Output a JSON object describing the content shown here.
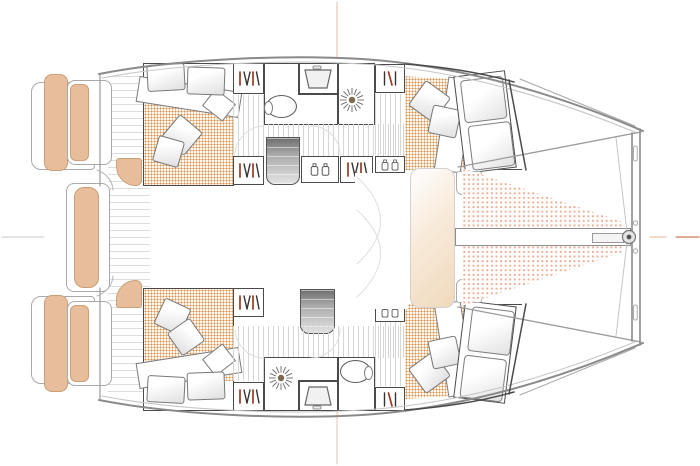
{
  "document": {
    "kind": "Catamaran interior deck plan, top-down line drawing, bow to the right",
    "visible_text": "none",
    "view": "hull accommodation level with aft cockpit and foredeck trampoline"
  },
  "theme": {
    "colors": {
      "outline_dark": "#4a4a4a",
      "outline_mid": "#8e8e8e",
      "outline_soft": "#c6c6c6",
      "cushion": "#e7bd9b",
      "cushion_edge": "#c9a078",
      "mattress_dot": "#dc9150",
      "mattress_bg": "#fdf7ee",
      "tramp_dot": "#eaab92",
      "tramp_bg": "#fffdfc",
      "plank": "#d6d6d6",
      "steps_dark": "#6e6e6e",
      "steps_light": "#e4e4e4",
      "hanger_red": "#9c3a22",
      "hanger_ink": "#333333",
      "centerline": "#c75f3d",
      "panel_beige": "#f0d9bd"
    }
  },
  "regions": {
    "stern_cockpit": {
      "swim_platforms": 2,
      "bench_cushions_tan": 5,
      "hull_entry_pads": 2,
      "floor": "planked"
    },
    "port_hull_top": {
      "aft_cabin": {
        "double_berth": true,
        "pillows": 2,
        "scatter_cushions": 2,
        "mattress_texture": "orange dots"
      },
      "head": {
        "toilet": 1,
        "sink": 1,
        "shower_with_drain_rose": 1
      },
      "wardrobes_with_hangers": 3,
      "lockers_with_jars": 2,
      "companionway_steps": 1,
      "forward_cabin": {
        "double_berth": true,
        "pillows": 2,
        "scatter_cushions": 2
      }
    },
    "starboard_hull_bottom": {
      "aft_cabin": {
        "double_berth": true,
        "pillows": 2,
        "scatter_cushions": 2,
        "mattress_texture": "orange dots"
      },
      "head": {
        "toilet": 1,
        "sink": 1,
        "shower_with_drain_rose": 1
      },
      "wardrobes_with_hangers": 3,
      "lockers_with_jars": 2,
      "companionway_steps": 1,
      "forward_cabin": {
        "double_berth": true,
        "pillows": 2,
        "scatter_cushions": 2
      }
    },
    "foredeck": {
      "trampoline_panels": 2,
      "bowsprit_beam": true,
      "bow_crossbeam": true,
      "bridle_lines": 2,
      "forward_lounge_panel": "beige gradient"
    },
    "drawing_marks": {
      "centerline_ticks": [
        "top orange",
        "bottom orange",
        "left grey",
        "right orange-red"
      ]
    }
  },
  "icons": [
    "shower-drain-rose-icon",
    "clothes-hanger-icon",
    "toiletry-jar-icon",
    "sink-basin-icon",
    "toilet-icon",
    "steps-icon",
    "pillow",
    "bowsprit-fitting-icon"
  ]
}
